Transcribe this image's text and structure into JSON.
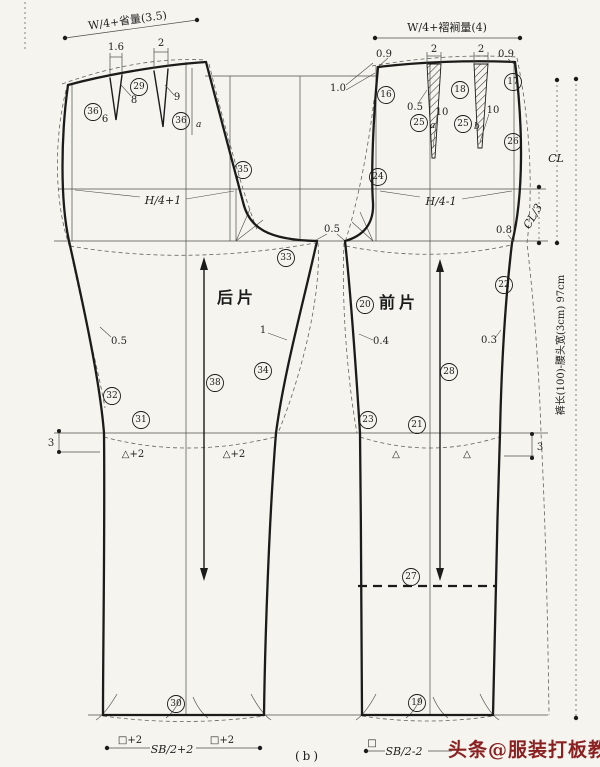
{
  "meta": {
    "caption": "(b)",
    "watermark": "头条@服装打板教程"
  },
  "pieces": {
    "back": "后片",
    "front": "前片"
  },
  "formulas": {
    "back_waist": "W/4+省量(3.5)",
    "front_waist": "W/4+褶裥量(4)",
    "back_hip": "H/4+1",
    "front_hip": "H/4-1",
    "back_knee_seg": "△+2",
    "front_knee_seg": "△",
    "back_hem_side": "□+2",
    "back_hem_center": "SB/2+2",
    "front_hem_side": "□",
    "front_hem_center": "SB/2-2",
    "cl": "CL",
    "cl_third": "CL/3",
    "length_note": "裤长(100)-腰头宽(3cm) 97cm"
  },
  "values": {
    "back_dart1_width": "1.6",
    "back_dart2_width": "2",
    "back_dart1_depth": "8",
    "back_dart2_depth": "9",
    "back_dart1_pos": "6",
    "point_a_back": "a",
    "front_drop_left": "0.9",
    "front_drop_right": "0.9",
    "pleat1_width": "2",
    "pleat2_width": "2",
    "side_raise": "1.0",
    "pleat_offset": "0.5",
    "pleat1_depth": "10",
    "pleat2_depth": "10",
    "point_a": "a",
    "point_b": "b",
    "crotch_gap": "0.5",
    "front_side_crotch": "0.8",
    "back_side_in": "0.5",
    "back_inseam_in": "1",
    "front_inseam_in": "0.4",
    "front_side_in": "0.3",
    "knee_up_left": "3",
    "knee_up_right": "3"
  },
  "markers": {
    "16": "16",
    "17": "17",
    "18": "18",
    "19": "19",
    "20": "20",
    "21": "21",
    "22": "22",
    "23": "23",
    "24": "24",
    "25a": "25",
    "25b": "25",
    "26": "26",
    "27": "27",
    "28": "28",
    "29": "29",
    "30": "30",
    "31": "31",
    "32": "32",
    "33": "33",
    "34": "34",
    "35": "35",
    "36l": "36",
    "36r": "36",
    "38": "38"
  }
}
